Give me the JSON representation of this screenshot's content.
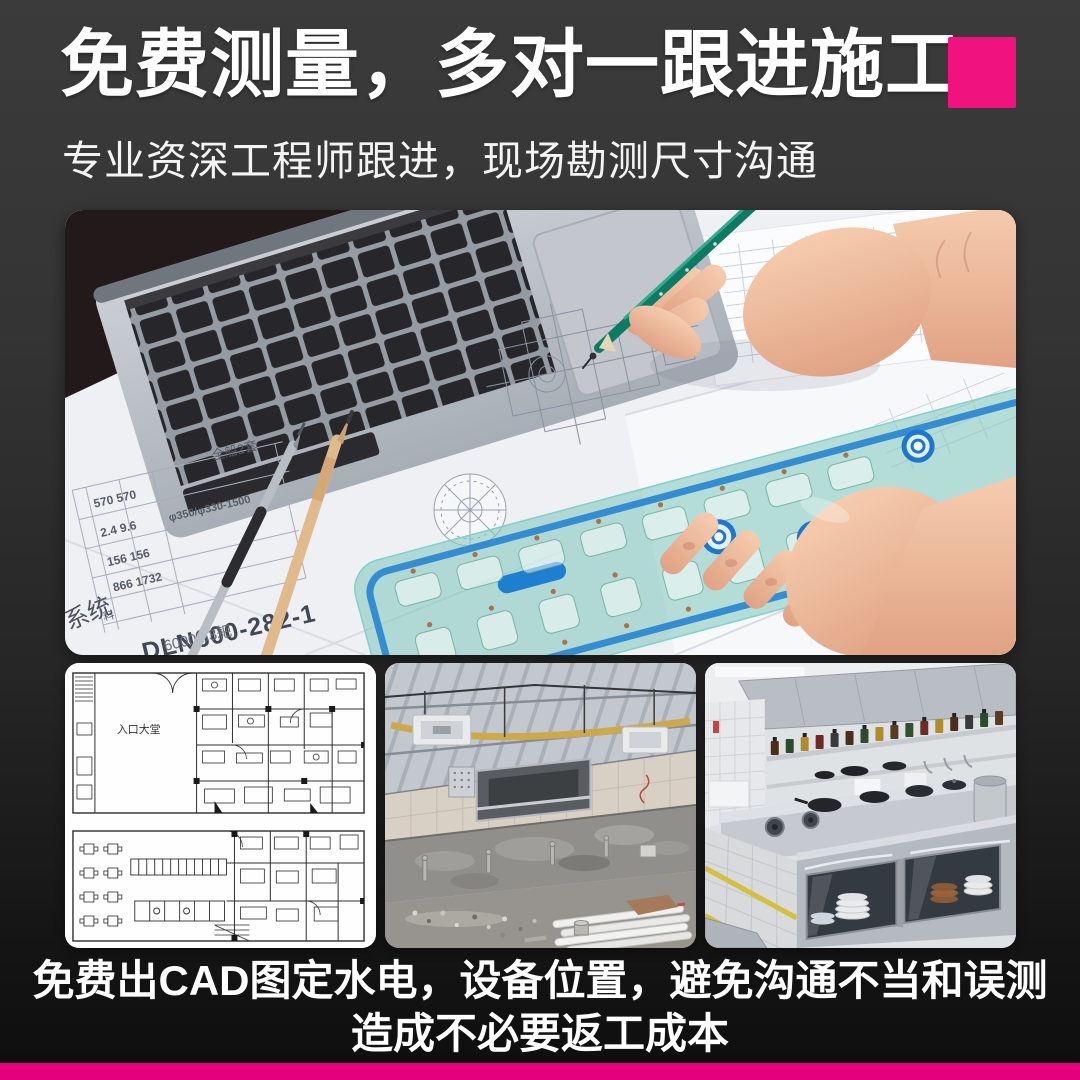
{
  "palette": {
    "background_top": "#3b3b3b",
    "background_bottom": "#0e0e0e",
    "text_color": "#ffffff",
    "accent_square": "#f0127f",
    "accent_bar": "#e4007d"
  },
  "header": {
    "title": "免费测量，多对一跟进施工",
    "subtitle": "专业资深工程师跟进，现场勘测尺寸沟通"
  },
  "hero": {
    "subject": "engineer-hands-drawing-on-blueprints-with-laptop-and-stencil",
    "blueprint": {
      "sheet_note": "全船2套",
      "table_rows": [
        "570 570",
        "2.4 9.6",
        "φ350/φ330-1500",
        "156 156",
        "866 1732"
      ],
      "side_label": "料",
      "drawing_number": "DLN600-282-1",
      "system_label": "系统",
      "spec_note": "6000M3耙"
    }
  },
  "gallery": {
    "items": [
      {
        "name": "cad-floor-plan",
        "label": "入口大堂"
      },
      {
        "name": "construction-site"
      },
      {
        "name": "finished-kitchen"
      }
    ]
  },
  "footer": {
    "line1": "免费出CAD图定水电，设备位置，避免沟通不当和误测",
    "line2": "造成不必要返工成本"
  }
}
